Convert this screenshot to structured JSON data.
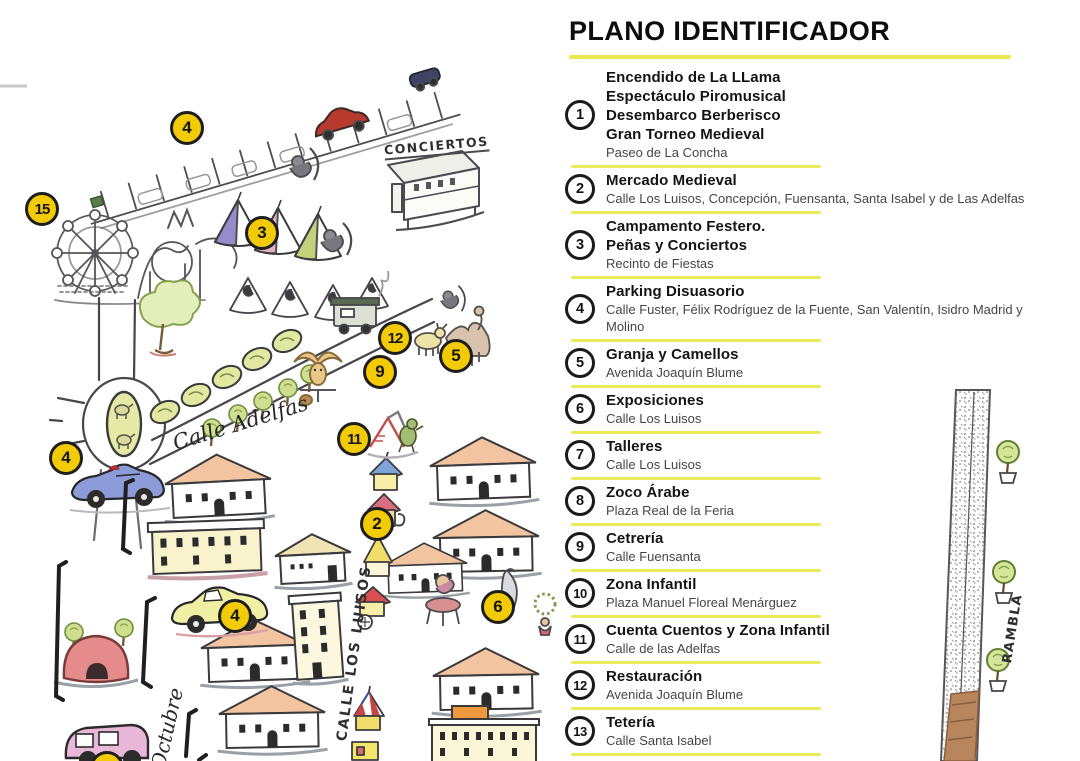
{
  "title": "PLANO IDENTIFICADOR",
  "legend": {
    "items": [
      {
        "number": "1",
        "lines": [
          "Encendido de La LLama",
          "Espectáculo Piromusical",
          "Desembarco Berberisco",
          "Gran Torneo Medieval"
        ],
        "location": "Paseo de La Concha"
      },
      {
        "number": "2",
        "lines": [
          "Mercado Medieval"
        ],
        "location": "Calle Los Luisos, Concepción, Fuensanta, Santa Isabel y de Las Adelfas"
      },
      {
        "number": "3",
        "lines": [
          "Campamento Festero.",
          "Peñas y Conciertos"
        ],
        "location": "Recinto de Fiestas"
      },
      {
        "number": "4",
        "lines": [
          "Parking Disuasorio"
        ],
        "location": "Calle Fuster,  Félix Rodríguez de la Fuente, San Valentín, Isidro Madrid y Molino"
      },
      {
        "number": "5",
        "lines": [
          "Granja y Camellos"
        ],
        "location": "Avenida Joaquín Blume"
      },
      {
        "number": "6",
        "lines": [
          "Exposiciones"
        ],
        "location": "Calle Los Luisos"
      },
      {
        "number": "7",
        "lines": [
          "Talleres"
        ],
        "location": "Calle Los Luisos"
      },
      {
        "number": "8",
        "lines": [
          "Zoco Árabe"
        ],
        "location": "Plaza Real de la Feria"
      },
      {
        "number": "9",
        "lines": [
          "Cetrería"
        ],
        "location": "Calle Fuensanta"
      },
      {
        "number": "10",
        "lines": [
          "Zona Infantil"
        ],
        "location": "Plaza Manuel Floreal Menárguez"
      },
      {
        "number": "11",
        "lines": [
          "Cuenta Cuentos y Zona Infantil"
        ],
        "location": "Calle de las Adelfas"
      },
      {
        "number": "12",
        "lines": [
          "Restauración"
        ],
        "location": "Avenida Joaquín Blume"
      },
      {
        "number": "13",
        "lines": [
          "Tetería"
        ],
        "location": "Calle Santa Isabel"
      },
      {
        "number": "14",
        "lines": [
          "Espectáculo de Clausura,",
          "Simulacro de Incendio"
        ],
        "location": ""
      }
    ]
  },
  "map": {
    "markers": [
      {
        "n": "4",
        "x": 187,
        "y": 128
      },
      {
        "n": "15",
        "x": 42,
        "y": 209
      },
      {
        "n": "3",
        "x": 262,
        "y": 233
      },
      {
        "n": "12",
        "x": 395,
        "y": 338
      },
      {
        "n": "5",
        "x": 456,
        "y": 356
      },
      {
        "n": "9",
        "x": 380,
        "y": 372
      },
      {
        "n": "11",
        "x": 354,
        "y": 439
      },
      {
        "n": "4",
        "x": 66,
        "y": 458
      },
      {
        "n": "2",
        "x": 377,
        "y": 524
      },
      {
        "n": "4",
        "x": 235,
        "y": 616
      },
      {
        "n": "6",
        "x": 498,
        "y": 607
      },
      {
        "n": "",
        "x": 107,
        "y": 768
      }
    ],
    "labels": {
      "conciertos": "CONCIERTOS",
      "calle_adelfas": "Calle Adelfas",
      "calle_los_luisos": "CALLE LOS LUISOS",
      "octubre": "Octubre",
      "rambla": "RAMBLA"
    }
  },
  "colors": {
    "marker_fill": "#F2CB05",
    "separator_yellow": "#E9E94F",
    "ink": "#4E4E52",
    "roof_peach": "#F2C5A0",
    "text_dark": "#111111",
    "text_muted": "#454545"
  }
}
